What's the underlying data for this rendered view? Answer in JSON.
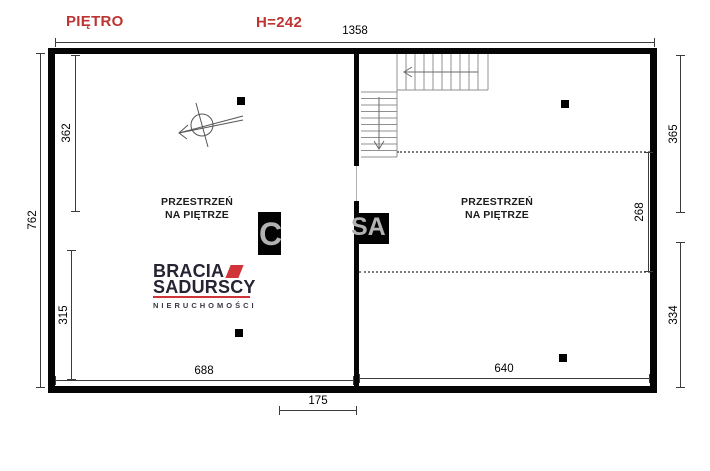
{
  "header": {
    "floor_label": "PIĘTRO",
    "ceiling_height_label": "H=242"
  },
  "dimensions": {
    "top_total": "1358",
    "left_outer_total": "762",
    "left_inner_top": "362",
    "left_inner_bottom": "315",
    "right_outer_top": "365",
    "right_outer_bottom": "334",
    "right_inner": "268",
    "bottom_left": "688",
    "bottom_right": "640",
    "bottom_center": "175"
  },
  "rooms": {
    "left": {
      "line1": "PRZESTRZEŃ",
      "line2": "NA PIĘTRZE"
    },
    "right": {
      "line1": "PRZESTRZEŃ",
      "line2": "NA PIĘTRZE"
    }
  },
  "logo": {
    "brand_line1": "BRACIA",
    "brand_line2": "SADURSCY",
    "brand_line3": "NIERUCHOMOŚCI"
  },
  "watermark": {
    "left_fragment": "C",
    "right_fragment": "SA"
  },
  "colors": {
    "label_red": "#bd3431",
    "logo_red": "#d13438",
    "logo_dark": "#262333",
    "wall_black": "#050505"
  }
}
